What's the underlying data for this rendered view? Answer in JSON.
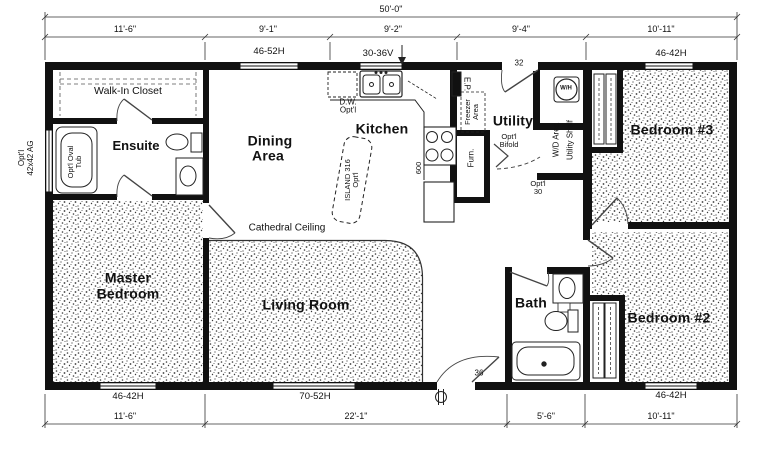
{
  "dimensions": {
    "overall_width": "50'-0\"",
    "top": [
      "11'-6\"",
      "9'-1\"",
      "9'-2\"",
      "9'-4\"",
      "10'-11\""
    ],
    "bottom": [
      "11'-6\"",
      "22'-1\"",
      "5'-6\"",
      "10'-11\""
    ]
  },
  "rooms": {
    "walk_in_closet": "Walk-In Closet",
    "ensuite": "Ensuite",
    "dining_1": "Dining",
    "dining_2": "Area",
    "kitchen": "Kitchen",
    "utility": "Utility",
    "bedroom3": "Bedroom #3",
    "master_1": "Master",
    "master_2": "Bedroom",
    "living_room": "Living Room",
    "bath": "Bath",
    "bedroom2": "Bedroom #2"
  },
  "windows": {
    "dining": "46-52H",
    "kitchen_sink": "30-36V",
    "bedroom3": "46-42H",
    "master": "46-42H",
    "living_room": "70-52H",
    "bedroom2": "46-42H"
  },
  "doors": {
    "utility_rear": "32",
    "front_entry": "36",
    "optional_interior_1": "Opt'l",
    "optional_interior_2": "30",
    "bifold_1": "Opt'l",
    "bifold_2": "Bifold"
  },
  "annotations": {
    "cathedral_ceiling": "Cathedral Ceiling",
    "dishwasher_1": "D.W.",
    "dishwasher_2": "Opt'l",
    "island_1": "ISLAND 316",
    "island_2": "Opt'l",
    "range_code": "600",
    "electrical_panel": "E.P.",
    "freezer_1": "Freezer",
    "freezer_2": "Area",
    "furnace": "Furn.",
    "water_heater": "W/H",
    "wd_area": "W/D Area",
    "utility_shelf": "Utility Shelf",
    "tub_1": "Opt'l Oval",
    "tub_2": "Tub",
    "opt_ag_1": "Opt'l",
    "opt_ag_2": "42x42 AG"
  },
  "colors": {
    "wall": "#111111",
    "line": "#1a1a1a",
    "background": "#ffffff"
  }
}
